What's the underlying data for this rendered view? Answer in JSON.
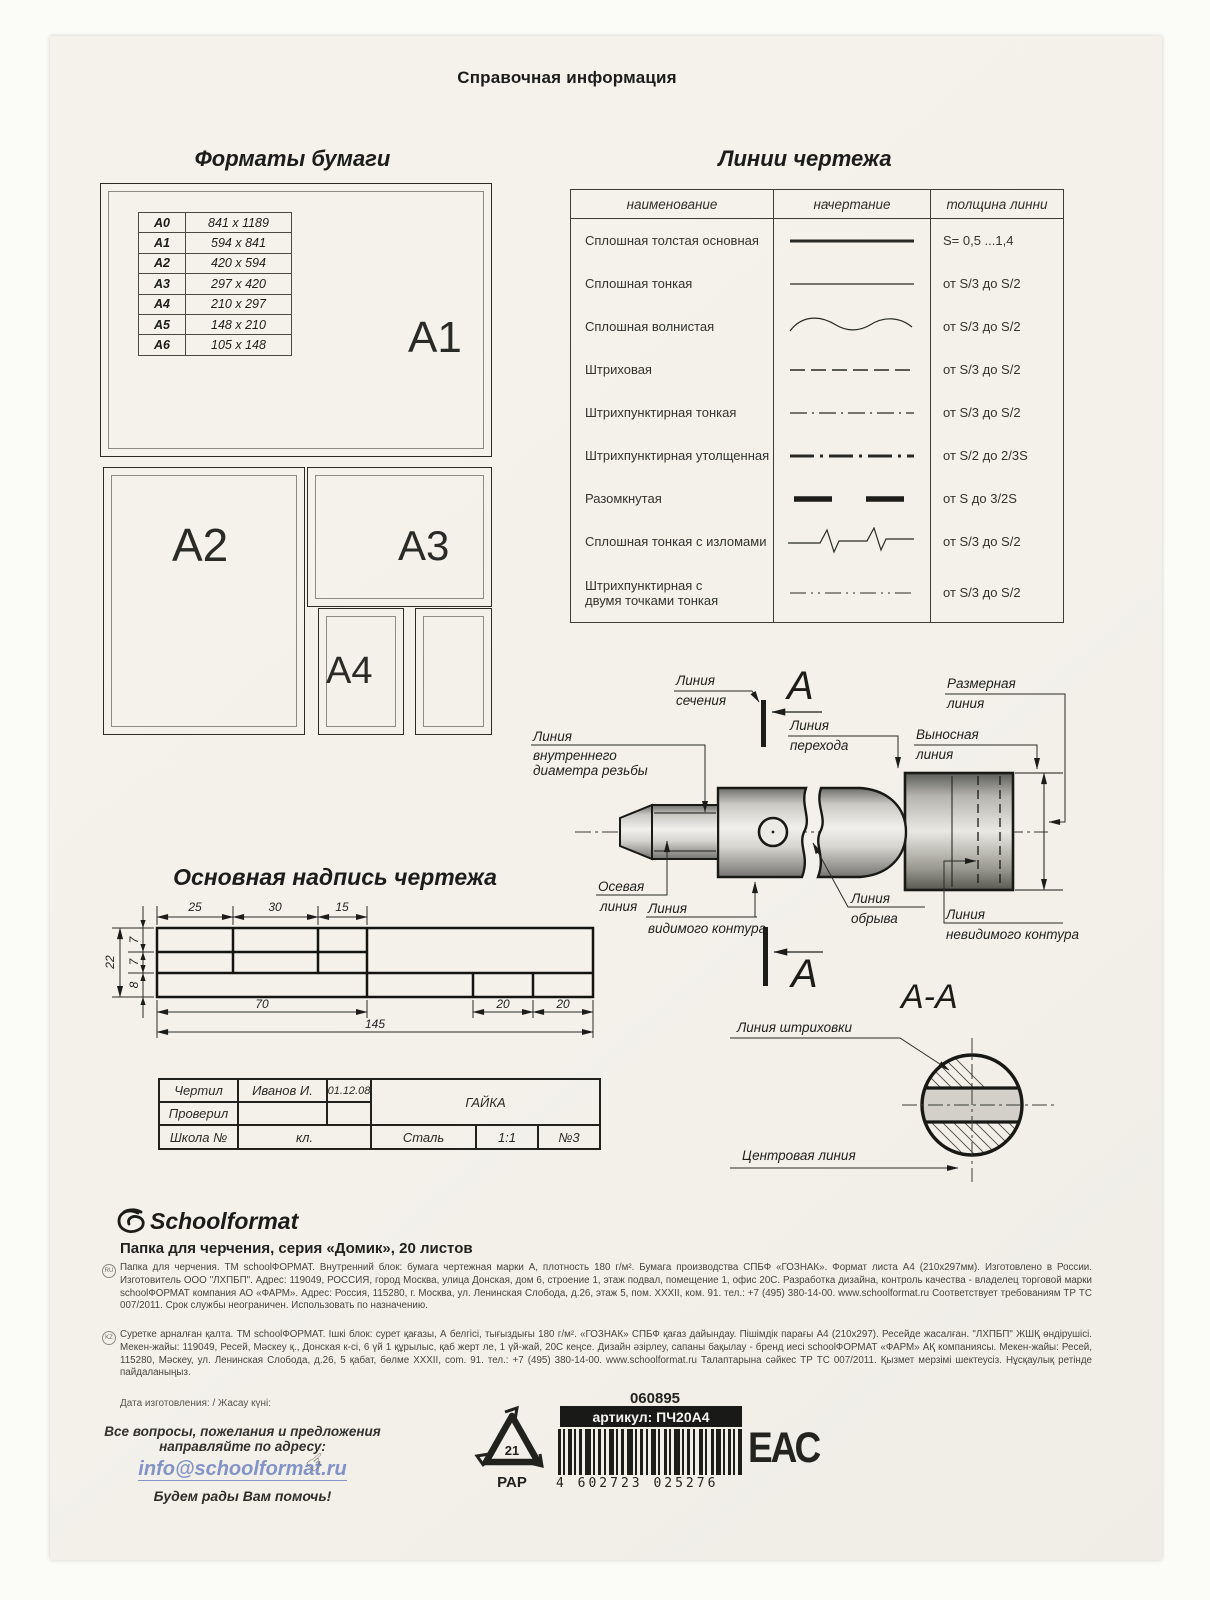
{
  "page": {
    "title": "Справочная информация"
  },
  "formats": {
    "heading": "Форматы бумаги",
    "rows": [
      {
        "f": "A0",
        "s": "841 x 1189"
      },
      {
        "f": "A1",
        "s": "594 x 841"
      },
      {
        "f": "A2",
        "s": "420 x 594"
      },
      {
        "f": "A3",
        "s": "297 x 420"
      },
      {
        "f": "A4",
        "s": "210 x 297"
      },
      {
        "f": "A5",
        "s": "148 x 210"
      },
      {
        "f": "A6",
        "s": "105 x 148"
      }
    ],
    "label_a1": "A1",
    "label_a2": "A2",
    "label_a3": "A3",
    "label_a4": "A4"
  },
  "lines": {
    "heading": "Линии чертежа",
    "col_name": "наименование",
    "col_sample": "начертание",
    "col_thickness": "толщина линни",
    "rows": [
      {
        "name": "Сплошная толстая основная",
        "name2": "",
        "thickness": "S= 0,5 ...1,4"
      },
      {
        "name": "Сплошная тонкая",
        "name2": "",
        "thickness": "от S/3 до S/2"
      },
      {
        "name": "Сплошная волнистая",
        "name2": "",
        "thickness": "от S/3 до S/2"
      },
      {
        "name": "Штриховая",
        "name2": "",
        "thickness": "от S/3 до S/2"
      },
      {
        "name": "Штрихпунктирная тонкая",
        "name2": "",
        "thickness": "от S/3 до S/2"
      },
      {
        "name": "Штрихпунктирная утолщенная",
        "name2": "",
        "thickness": "от S/2 до 2/3S"
      },
      {
        "name": "Разомкнутая",
        "name2": "",
        "thickness": "от S до 3/2S"
      },
      {
        "name": "Сплошная тонкая с изломами",
        "name2": "",
        "thickness": "от S/3 до S/2"
      },
      {
        "name": "Штрихпунктирная с",
        "name2": "двумя точками тонкая",
        "thickness": "от S/3 до S/2"
      }
    ]
  },
  "figure": {
    "label_section_1": "Линия",
    "label_section_2": "сечения",
    "letter_a_top": "А",
    "letter_a_bottom": "А",
    "section_title": "А-А",
    "label_dim_1": "Размерная",
    "label_dim_2": "линия",
    "label_ext_1": "Выносная",
    "label_ext_2": "линия",
    "label_trans_1": "Линия",
    "label_trans_2": "перехода",
    "label_thread_1": "Линия",
    "label_thread_2": "внутреннего",
    "label_thread_3": "диаметра резьбы",
    "label_axis_1": "Осевая",
    "label_axis_2": "линия",
    "label_visible_1": "Линия",
    "label_visible_2": "видимого контура",
    "label_break_1": "Линия",
    "label_break_2": "обрыва",
    "label_hidden_1": "Линия",
    "label_hidden_2": "невидимого контура",
    "label_hatch": "Линия штриховки",
    "label_center": "Центровая линия"
  },
  "titleblock": {
    "heading": "Основная надпись чертежа",
    "dims": {
      "w25": "25",
      "w30": "30",
      "w15": "15",
      "h7a": "7",
      "h7b": "7",
      "h8": "8",
      "h22": "22",
      "w70": "70",
      "w20a": "20",
      "w20b": "20",
      "w145": "145"
    },
    "cells": {
      "drew": "Чертил",
      "name": "Иванов И.",
      "date": "01.12.08",
      "checked": "Проверил",
      "title": "ГАЙКА",
      "school": "Школа №",
      "klass": "кл.",
      "material": "Сталь",
      "scale": "1:1",
      "num": "№3"
    }
  },
  "footer": {
    "brand": "Schoolformat",
    "product": "Папка для черчения, серия «Домик», 20 листов",
    "ru_mark": "RU",
    "kz_mark": "KZ",
    "ru_text": "Папка для черчения. ТМ schoolФОРМАТ. Внутренний блок: бумага чертежная марки А, плотность 180 г/м². Бумага производства СПБФ «ГОЗНАК». Формат листа А4 (210х297мм). Изготовлено в России. Изготовитель ООО \"ЛХПБП\". Адрес: 119049, РОССИЯ, город Москва, улица Донская, дом 6, строение 1, этаж подвал, помещение 1, офис 20С. Разработка дизайна, контроль качества - владелец торговой марки schoolФОРМАТ компания АО «ФАРМ». Адрес: Россия, 115280, г. Москва, ул. Ленинская Слобода, д.26, этаж 5, пом. XXXII, ком. 91. тел.: +7 (495) 380-14-00. www.schoolformat.ru Соответствует требованиям ТР ТС 007/2011. Срок службы неограничен. Использовать по назначению.",
    "kz_text": "Суретке арналған қалта. ТМ schoolФОРМАТ. Ішкі блок: сурет қағазы, А белгісі, тығыздығы 180 г/м². «ГОЗНАК» СПБФ қағаз дайындау. Пішімдік парағы А4 (210х297). Ресейде жасалған. \"ЛХПБП\" ЖШҚ өндірушісі. Мекен-жайы: 119049, Ресей, Мәскеу қ., Донская к-сі, 6 үй 1 құрылыс, қаб жерт ле, 1 үй-жай, 20С кеңсе. Дизайн әзірлеу, сапаны бақылау - бренд иесі schoolФОРМАТ «ФАРМ» АҚ компаниясы. Мекен-жайы: Ресей, 115280, Мәскеу, ул. Ленинская Слобода, д.26, 5 қабат, бөлме XXXII, com. 91. тел.: +7 (495) 380-14-00. www.schoolformat.ru Талаптарына сәйкес ТР ТС 007/2011. Қызмет мерзімі шектеусіз. Нұсқаулық ретінде пайдаланыңыз.",
    "date_label": "Дата изготовления: / Жасау күні:",
    "contact_line": "Все вопросы, пожелания и предложения направляйте по адресу:",
    "email": "info@schoolformat.ru",
    "help_line": "Будем рады Вам помочь!",
    "code": "060895",
    "sku": "артикул: ПЧ20А4",
    "barcode": "4 602723 025276",
    "recycle_num": "21",
    "recycle_mat": "PAP",
    "eac": "ЕАС"
  },
  "colors": {
    "card": "#f3f1ea",
    "ink": "#1c1c1a",
    "email_blue": "#8293c7"
  }
}
